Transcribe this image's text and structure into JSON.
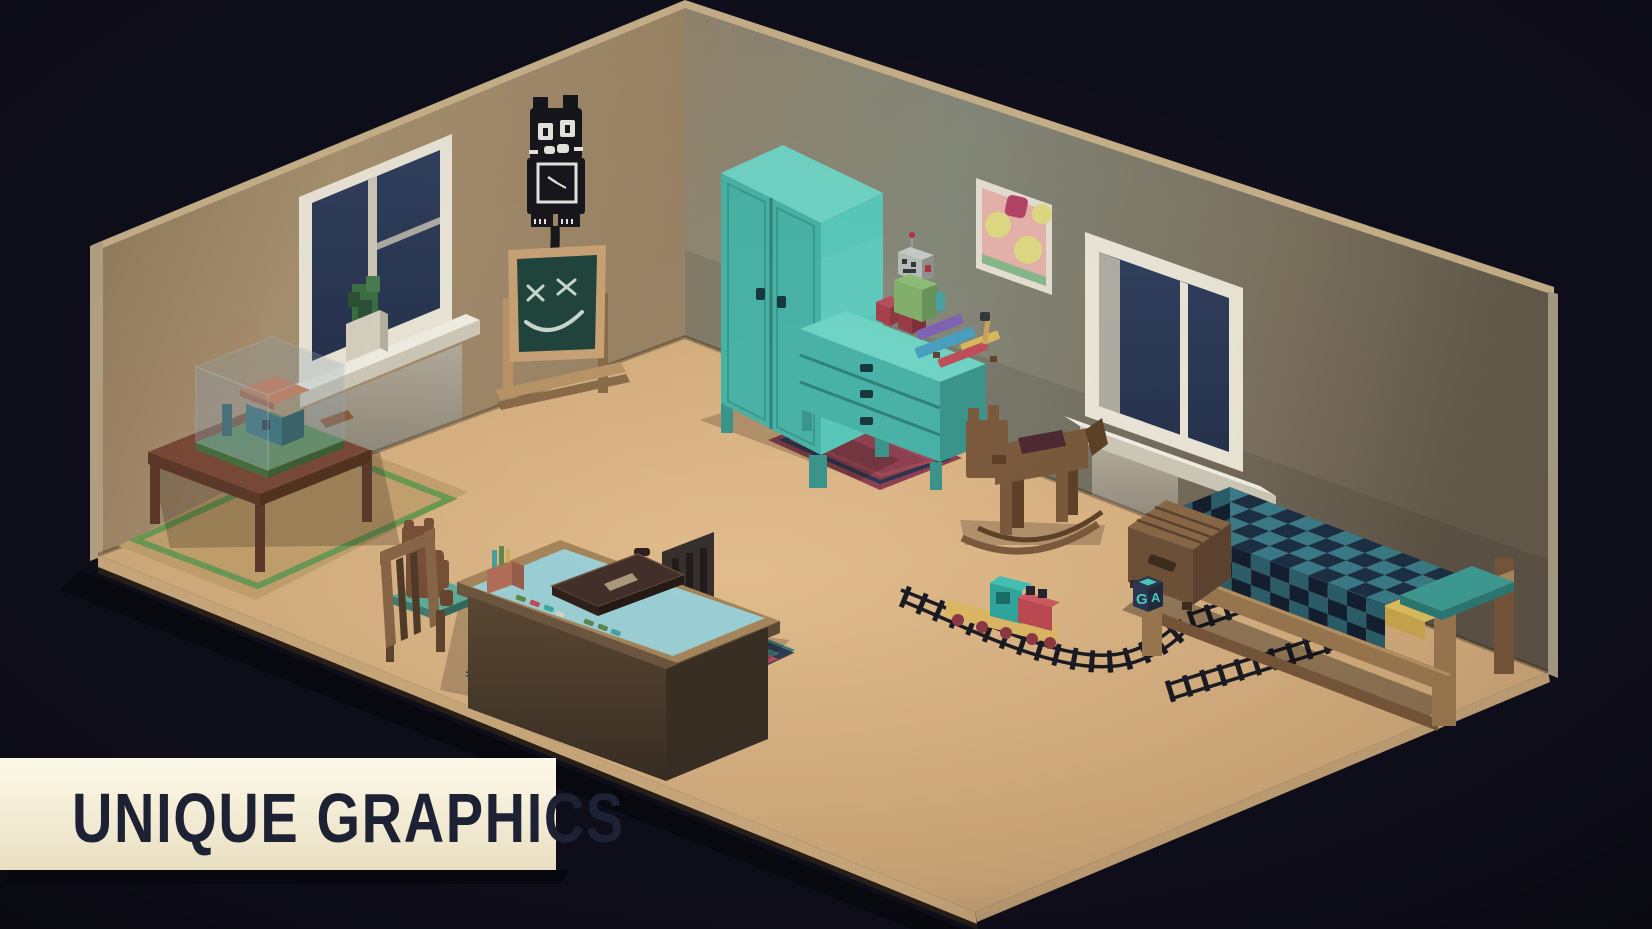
{
  "banner": {
    "label": "UNIQUE GRAPHICS"
  },
  "toy_cube": {
    "letters": {
      "front": "G",
      "side": "A"
    }
  },
  "scene": {
    "objects": [
      "left-wall",
      "right-wall",
      "floor",
      "window-left",
      "window-right",
      "potted-plant",
      "cat-clock",
      "chalkboard",
      "wall-painting",
      "wardrobe",
      "dresser",
      "toy-robot",
      "toy-blocks",
      "toy-xylophone",
      "display-table",
      "model-house-case",
      "area-rug-left",
      "desk-rug",
      "dresser-rug",
      "kids-desk",
      "desk-chair",
      "side-chair",
      "teddy-bear",
      "briefcase",
      "pencil-cup",
      "crayons",
      "rocking-horse",
      "toy-train",
      "train-tracks",
      "bed",
      "toy-chest",
      "letter-cube"
    ]
  },
  "palette": {
    "bg": "#0f0e1b",
    "banner_bg": "#fdf9e9",
    "banner_bg2": "#e9dfc2",
    "banner_text": "#1c2133",
    "banner_shadow": "#07070e",
    "wall_left": "#a89270",
    "wall_left_dark": "#8e775a",
    "wall_right": "#93866f",
    "wall_right_mid": "#85897a",
    "wall_right_dark": "#655b4c",
    "wall_trim": "#c9b28b",
    "floor_light": "#e5bf8f",
    "floor": "#d2ab7b",
    "floor_dark": "#bb9670",
    "floor_edge": "#cdab7d",
    "glass": "#27334d",
    "glass_light": "#31405f",
    "frame_white": "#ece7d8",
    "frame_shade": "#cfc9b8",
    "panel_grey": "#a89f90",
    "plant": "#3e6f46",
    "pot": "#d8d2c2",
    "clock_black": "#16161d",
    "chalk_white": "#dce8de",
    "board_green": "#20453c",
    "board_frame": "#c9a377",
    "stand_wood": "#b99568",
    "wood": "#8a6848",
    "wood_dark": "#5e452f",
    "wood_light": "#a07850",
    "table_top": "#7c4a38",
    "table_side": "#5f3a2c",
    "case_glass": "#8ea6b5",
    "case_green": "#5d8a57",
    "house_teal": "#2f6b72",
    "house_roof": "#cd7a55",
    "rug_tan": "#c6a36f",
    "rug_green": "#6d9c55",
    "rug_teal": "#3e7e7c",
    "rug_red": "#b5485a",
    "rug_navy": "#2e3550",
    "rug_maroon": "#8e4050",
    "teal_front": "#49b2a6",
    "teal_side": "#58c8ba",
    "teal_top": "#70d4c5",
    "teal_dark": "#3a958b",
    "handle_dark": "#17393c",
    "desk_wood": "#a8875d",
    "desk_top": "#9ed2d8",
    "desk_panel": "#5c4934",
    "desk_panel_dark": "#3a2f24",
    "chair_seat": "#5fae9c",
    "chair_dark": "#37302c",
    "bear": "#7a5038",
    "blanket_navy": "#1d3044",
    "blanket_teal": "#3b7c88",
    "blanket_navy_dk": "#141f30",
    "blanket_teal_dk": "#2c5f6b",
    "sheet_yellow": "#dfc060",
    "pillow": "#3f9d94",
    "bed_wood": "#9a7850",
    "bed_wood_dark": "#77573a",
    "cube_navy": "#2b3850",
    "cube_teal": "#4fc9c0",
    "horse": "#7b5a3d",
    "horse_dark": "#5e4129",
    "saddle": "#4e2b33",
    "train_yellow": "#dfb964",
    "train_teal": "#2fa89e",
    "train_red": "#bf4a52",
    "wheel": "#8e3944",
    "track": "#1b1b24",
    "robot_grey": "#b9bdb9",
    "robot_green": "#82b06c",
    "robot_red": "#b0333c",
    "xylo_purple": "#7f63b5",
    "xylo_blue": "#4a9fc0",
    "xylo_yellow": "#d9b95f",
    "xylo_red": "#bf4f5a",
    "paint_pink": "#e6b3ac",
    "paint_yellow": "#e0da85",
    "paint_magenta": "#b54467",
    "paint_green": "#87b98b",
    "paint_frame": "#e5e0d2"
  }
}
